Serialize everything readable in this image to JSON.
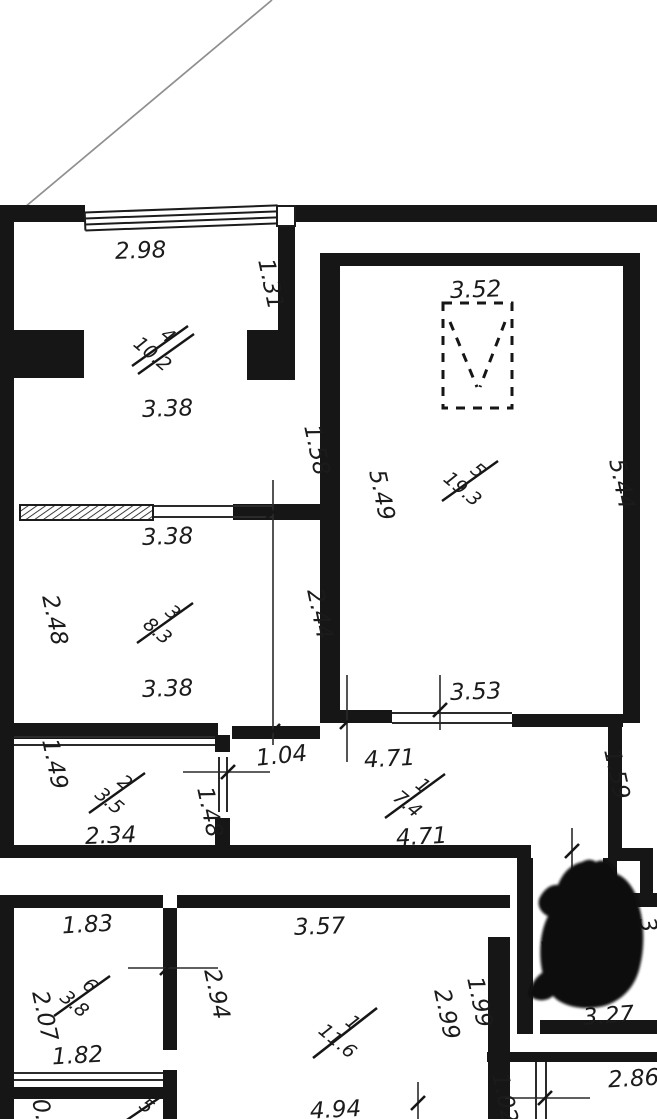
{
  "plan": {
    "type": "apartment-floor-plan",
    "colors": {
      "wall": "#161616",
      "thin_line": "#2b2b2b",
      "diagonal_line": "#8f8f8f",
      "background": "#ffffff",
      "redaction": "#0a0a0a"
    },
    "rooms": [
      {
        "number": "4",
        "area": "10.2"
      },
      {
        "number": "5",
        "area": "19.3"
      },
      {
        "number": "3",
        "area": "8.3"
      },
      {
        "number": "2",
        "area": "3.5"
      },
      {
        "number": "1",
        "area": "7.4"
      },
      {
        "number": "6",
        "area": "3.8"
      },
      {
        "number": "1",
        "area": "11.6"
      }
    ],
    "partial_room_label": "5",
    "dims": {
      "d298": "2.98",
      "d131": "1.31",
      "d338a": "3.38",
      "d338b": "3.38",
      "d338c": "3.38",
      "d158": "1.58",
      "d352": "3.52",
      "d549": "5.49",
      "d544": "5.44",
      "d248": "2.48",
      "d244": "2.44",
      "d149": "1.49",
      "d234": "2.34",
      "d148": "1.48",
      "d104": "1.04",
      "d353": "3.53",
      "d471a": "4.71",
      "d471b": "4.71",
      "d159": "1.59",
      "d183": "1.83",
      "d207": "2.07",
      "d182": "1.82",
      "d294": "2.94",
      "d357": "3.57",
      "d199": "1.99",
      "d299": "2.99",
      "d15": "1.5",
      "d327": "3.27",
      "d3partial": "3",
      "d286": "2.86",
      "d102": "1.02",
      "d494": "4.94",
      "d09": "0.9"
    }
  }
}
